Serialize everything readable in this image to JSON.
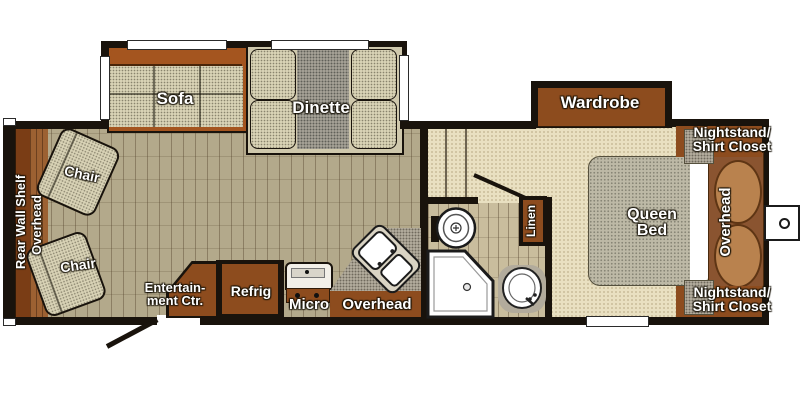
{
  "labels": {
    "sofa": "Sofa",
    "dinette": "Dinette",
    "chair_top": "Chair",
    "chair_bottom": "Chair",
    "rear_wall_shelf": "Rear Wall Shelf",
    "rear_overhead": "Overhead",
    "entertainment_line1": "Entertain-",
    "entertainment_line2": "ment Ctr.",
    "refrig": "Refrig",
    "micro": "Micro",
    "kitchen_overhead": "Overhead",
    "linen": "Linen",
    "wardrobe": "Wardrobe",
    "queen_line1": "Queen",
    "queen_line2": "Bed",
    "bed_overhead": "Overhead",
    "nightstand_top_line1": "Nightstand/",
    "nightstand_top_line2": "Shirt Closet",
    "nightstand_bottom_line1": "Nightstand/",
    "nightstand_bottom_line2": "Shirt Closet"
  },
  "colors": {
    "wall": "#19130c",
    "cabinet_brown": "#8d4c1e",
    "sofa_back_brown": "#a4551f",
    "tile_floor": "#b3a98b",
    "bedroom_carpet": "#e9e0c1",
    "fabric_speckle": "#d8d2b5",
    "table_gray": "#a5a195",
    "counter_gray": "#b2ab9c",
    "bed_gray": "#bdb9a6",
    "pillow_tan": "#b9824e",
    "wood_floor": "#9c6132",
    "shelf_brown": "#7a3d15",
    "label_text": "#ffffff"
  }
}
